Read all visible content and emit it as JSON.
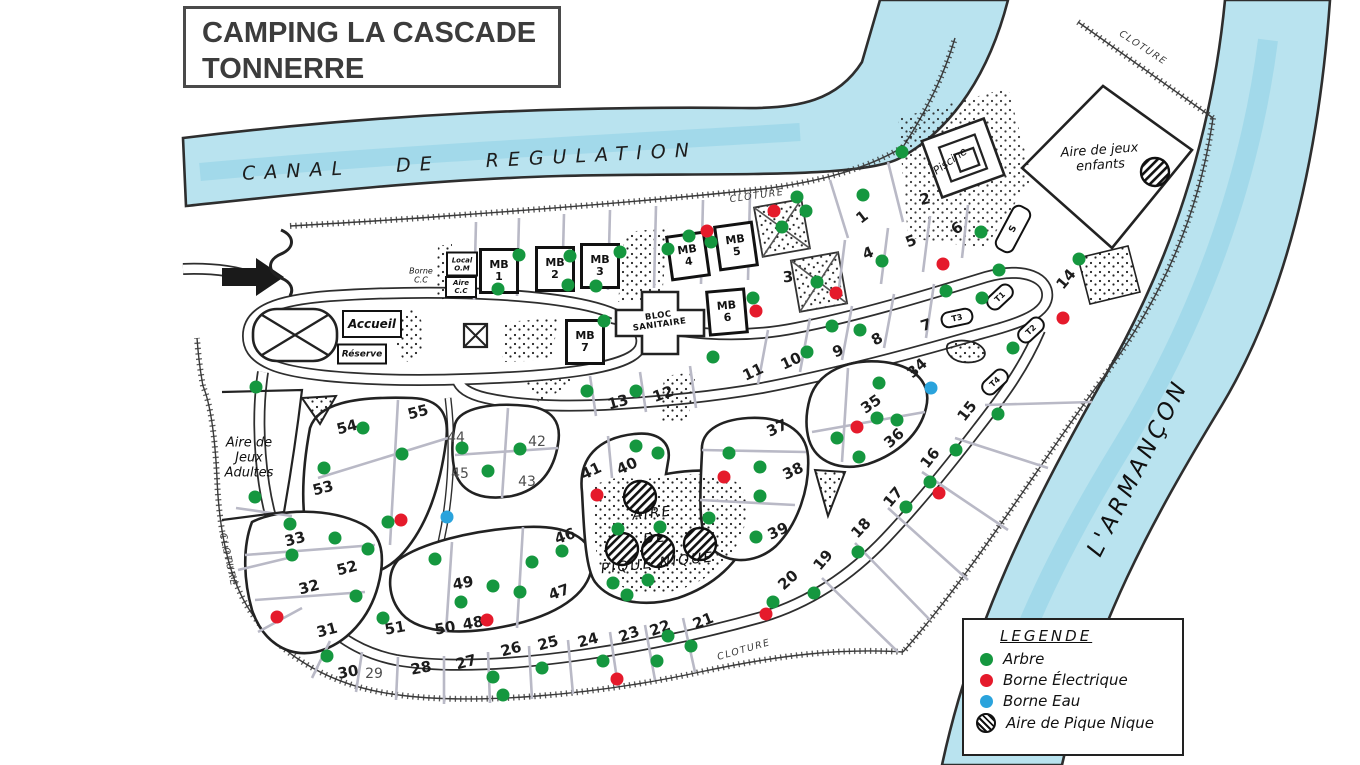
{
  "title": {
    "line1": "CAMPING LA CASCADE",
    "line2": "TONNERRE"
  },
  "legend": {
    "title": "LEGENDE",
    "items": [
      {
        "label": "Arbre",
        "type": "tree",
        "color": "#15973f"
      },
      {
        "label": "Borne Électrique",
        "type": "electric",
        "color": "#e51a2b"
      },
      {
        "label": "Borne Eau",
        "type": "water",
        "color": "#2aa3dc"
      },
      {
        "label": "Aire de Pique Nique",
        "type": "picnic",
        "color": "hatch"
      }
    ]
  },
  "colors": {
    "tree": "#15973f",
    "electric": "#e51a2b",
    "water": "#2aa3dc",
    "water_fill": "#b9e3ef",
    "ink": "#2d2d2d"
  },
  "map_labels": [
    {
      "text": "CANAL   DE   REGULATION",
      "x": 470,
      "y": 162,
      "rot": -3,
      "cls": "canal",
      "name": "canal-label"
    },
    {
      "text": "L'ARMANÇON",
      "x": 1138,
      "y": 468,
      "rot": -63,
      "cls": "river",
      "name": "river-label"
    },
    {
      "text": "CLOTURE",
      "x": 757,
      "y": 196,
      "rot": -8,
      "cls": "fence",
      "name": "fence-label-top"
    },
    {
      "text": "CLOTURE",
      "x": 1143,
      "y": 48,
      "rot": 33,
      "cls": "fence",
      "name": "fence-label-topright"
    },
    {
      "text": "CLOTURE",
      "x": 228,
      "y": 560,
      "rot": 78,
      "cls": "fence",
      "name": "fence-label-left"
    },
    {
      "text": "CLOTURE",
      "x": 744,
      "y": 650,
      "rot": -16,
      "cls": "fence",
      "name": "fence-label-bottom"
    },
    {
      "text": "Piscine",
      "x": 950,
      "y": 161,
      "rot": -35,
      "cls": "hand-sm",
      "name": "pool-label"
    },
    {
      "text": "Aire de jeux\nenfants",
      "x": 1100,
      "y": 158,
      "rot": -4,
      "cls": "hand",
      "name": "kids-playground-label"
    },
    {
      "text": "Aire de\nJeux\nAdultes",
      "x": 249,
      "y": 458,
      "rot": 0,
      "cls": "hand",
      "name": "adult-playground-label"
    },
    {
      "text": "AIRE\nDE\nPIQUE NIQUE",
      "x": 655,
      "y": 539,
      "rot": -6,
      "cls": "hand-lg",
      "name": "picnic-area-label"
    },
    {
      "text": "BLOC\nSANITAIRE",
      "x": 659,
      "y": 321,
      "rot": -8,
      "cls": "tiny-bold",
      "name": "sanitary-block-label"
    },
    {
      "text": "Borne\nC.C",
      "x": 421,
      "y": 276,
      "rot": 0,
      "cls": "tiny",
      "name": "borne-cc-label"
    }
  ],
  "boxes": [
    {
      "text": "MB\n1",
      "x": 499,
      "y": 271,
      "w": 34,
      "h": 40,
      "rot": 0,
      "cls": "mb",
      "name": "mobile-home-1"
    },
    {
      "text": "MB\n2",
      "x": 555,
      "y": 269,
      "w": 34,
      "h": 40,
      "rot": 0,
      "cls": "mb",
      "name": "mobile-home-2"
    },
    {
      "text": "MB\n3",
      "x": 600,
      "y": 266,
      "w": 34,
      "h": 40,
      "rot": 0,
      "cls": "mb",
      "name": "mobile-home-3"
    },
    {
      "text": "MB\n4",
      "x": 688,
      "y": 256,
      "w": 34,
      "h": 40,
      "rot": -8,
      "cls": "mb",
      "name": "mobile-home-4"
    },
    {
      "text": "MB\n5",
      "x": 736,
      "y": 246,
      "w": 34,
      "h": 40,
      "rot": -8,
      "cls": "mb",
      "name": "mobile-home-5"
    },
    {
      "text": "MB\n6",
      "x": 727,
      "y": 312,
      "w": 34,
      "h": 40,
      "rot": -5,
      "cls": "mb",
      "name": "mobile-home-6"
    },
    {
      "text": "MB\n7",
      "x": 585,
      "y": 342,
      "w": 34,
      "h": 40,
      "rot": 0,
      "cls": "mb",
      "name": "mobile-home-7"
    },
    {
      "text": "Accueil",
      "x": 372,
      "y": 324,
      "w": 56,
      "h": 24,
      "rot": 0,
      "cls": "plain",
      "fs": 12,
      "name": "reception"
    },
    {
      "text": "Réserve",
      "x": 362,
      "y": 354,
      "w": 46,
      "h": 17,
      "rot": 0,
      "cls": "plain",
      "fs": 9,
      "name": "reserve"
    },
    {
      "text": "Local\nO.M",
      "x": 462,
      "y": 264,
      "w": 28,
      "h": 21,
      "rot": 0,
      "cls": "plain",
      "fs": 7,
      "name": "local-om"
    },
    {
      "text": "Aire\nC.C",
      "x": 461,
      "y": 287,
      "w": 28,
      "h": 18,
      "rot": 0,
      "cls": "plain",
      "fs": 7,
      "name": "aire-cc"
    },
    {
      "text": "S",
      "x": 1013,
      "y": 229,
      "w": 46,
      "h": 17,
      "rot": -62,
      "cls": "rounded",
      "fs": 9,
      "name": "building-s"
    },
    {
      "text": "T1",
      "x": 1000,
      "y": 297,
      "w": 27,
      "h": 13,
      "rot": -43,
      "cls": "rounded",
      "fs": 8,
      "name": "tent-t1"
    },
    {
      "text": "T2",
      "x": 1031,
      "y": 330,
      "w": 27,
      "h": 13,
      "rot": -43,
      "cls": "rounded",
      "fs": 8,
      "name": "tent-t2"
    },
    {
      "text": "T3",
      "x": 957,
      "y": 318,
      "w": 29,
      "h": 13,
      "rot": -12,
      "cls": "rounded",
      "fs": 8,
      "name": "tent-t3"
    },
    {
      "text": "T4",
      "x": 995,
      "y": 382,
      "w": 27,
      "h": 13,
      "rot": -43,
      "cls": "rounded",
      "fs": 8,
      "name": "tent-t4"
    }
  ],
  "pitches": [
    {
      "n": "1",
      "x": 862,
      "y": 217,
      "r": -38
    },
    {
      "n": "2",
      "x": 925,
      "y": 199,
      "r": -12
    },
    {
      "n": "3",
      "x": 788,
      "y": 277,
      "r": -5
    },
    {
      "n": "4",
      "x": 868,
      "y": 253,
      "r": -22
    },
    {
      "n": "5",
      "x": 911,
      "y": 241,
      "r": -22
    },
    {
      "n": "6",
      "x": 957,
      "y": 228,
      "r": -35
    },
    {
      "n": "7",
      "x": 926,
      "y": 325,
      "r": -18
    },
    {
      "n": "8",
      "x": 877,
      "y": 339,
      "r": -28
    },
    {
      "n": "9",
      "x": 838,
      "y": 351,
      "r": -22
    },
    {
      "n": "10",
      "x": 791,
      "y": 361,
      "r": -25
    },
    {
      "n": "11",
      "x": 753,
      "y": 372,
      "r": -25
    },
    {
      "n": "12",
      "x": 663,
      "y": 394,
      "r": -20
    },
    {
      "n": "13",
      "x": 618,
      "y": 402,
      "r": -15
    },
    {
      "n": "14",
      "x": 1066,
      "y": 279,
      "r": -50
    },
    {
      "n": "15",
      "x": 967,
      "y": 411,
      "r": -52
    },
    {
      "n": "16",
      "x": 930,
      "y": 458,
      "r": -52
    },
    {
      "n": "17",
      "x": 893,
      "y": 497,
      "r": -50
    },
    {
      "n": "18",
      "x": 861,
      "y": 528,
      "r": -47
    },
    {
      "n": "19",
      "x": 823,
      "y": 560,
      "r": -50
    },
    {
      "n": "20",
      "x": 788,
      "y": 580,
      "r": -42
    },
    {
      "n": "21",
      "x": 703,
      "y": 621,
      "r": -22
    },
    {
      "n": "22",
      "x": 660,
      "y": 628,
      "r": -20
    },
    {
      "n": "23",
      "x": 629,
      "y": 634,
      "r": -20
    },
    {
      "n": "24",
      "x": 588,
      "y": 640,
      "r": -15
    },
    {
      "n": "25",
      "x": 548,
      "y": 643,
      "r": -15
    },
    {
      "n": "26",
      "x": 511,
      "y": 649,
      "r": -15
    },
    {
      "n": "27",
      "x": 466,
      "y": 662,
      "r": -15
    },
    {
      "n": "28",
      "x": 421,
      "y": 668,
      "r": -10
    },
    {
      "n": "29",
      "x": 374,
      "y": 674,
      "r": 0,
      "thin": true
    },
    {
      "n": "30",
      "x": 348,
      "y": 672,
      "r": -10
    },
    {
      "n": "31",
      "x": 327,
      "y": 630,
      "r": -15
    },
    {
      "n": "32",
      "x": 309,
      "y": 587,
      "r": -15
    },
    {
      "n": "33",
      "x": 295,
      "y": 539,
      "r": -15
    },
    {
      "n": "34",
      "x": 917,
      "y": 368,
      "r": -42
    },
    {
      "n": "35",
      "x": 871,
      "y": 404,
      "r": -35
    },
    {
      "n": "36",
      "x": 894,
      "y": 438,
      "r": -42
    },
    {
      "n": "37",
      "x": 777,
      "y": 428,
      "r": -25
    },
    {
      "n": "38",
      "x": 793,
      "y": 471,
      "r": -25
    },
    {
      "n": "39",
      "x": 778,
      "y": 531,
      "r": -25
    },
    {
      "n": "40",
      "x": 627,
      "y": 466,
      "r": -25
    },
    {
      "n": "41",
      "x": 591,
      "y": 471,
      "r": -25
    },
    {
      "n": "42",
      "x": 537,
      "y": 442,
      "r": 0,
      "thin": true
    },
    {
      "n": "43",
      "x": 527,
      "y": 482,
      "r": 0,
      "thin": true
    },
    {
      "n": "44",
      "x": 456,
      "y": 438,
      "r": 0,
      "thin": true
    },
    {
      "n": "45",
      "x": 460,
      "y": 474,
      "r": 0,
      "thin": true
    },
    {
      "n": "46",
      "x": 565,
      "y": 536,
      "r": -20
    },
    {
      "n": "47",
      "x": 559,
      "y": 592,
      "r": -20
    },
    {
      "n": "48",
      "x": 473,
      "y": 623,
      "r": -10
    },
    {
      "n": "49",
      "x": 463,
      "y": 583,
      "r": -10
    },
    {
      "n": "50",
      "x": 445,
      "y": 628,
      "r": -10
    },
    {
      "n": "51",
      "x": 395,
      "y": 628,
      "r": -10
    },
    {
      "n": "52",
      "x": 347,
      "y": 568,
      "r": -15
    },
    {
      "n": "53",
      "x": 323,
      "y": 488,
      "r": -15
    },
    {
      "n": "54",
      "x": 347,
      "y": 427,
      "r": -15
    },
    {
      "n": "55",
      "x": 418,
      "y": 412,
      "r": -15
    }
  ],
  "markers": {
    "trees": [
      [
        519,
        255
      ],
      [
        570,
        256
      ],
      [
        620,
        252
      ],
      [
        498,
        289
      ],
      [
        568,
        285
      ],
      [
        596,
        286
      ],
      [
        668,
        249
      ],
      [
        689,
        236
      ],
      [
        711,
        242
      ],
      [
        604,
        321
      ],
      [
        753,
        298
      ],
      [
        797,
        197
      ],
      [
        806,
        211
      ],
      [
        782,
        227
      ],
      [
        863,
        195
      ],
      [
        902,
        152
      ],
      [
        882,
        261
      ],
      [
        946,
        291
      ],
      [
        981,
        232
      ],
      [
        999,
        270
      ],
      [
        982,
        298
      ],
      [
        1013,
        348
      ],
      [
        1079,
        259
      ],
      [
        817,
        282
      ],
      [
        832,
        326
      ],
      [
        860,
        330
      ],
      [
        807,
        352
      ],
      [
        713,
        357
      ],
      [
        587,
        391
      ],
      [
        636,
        391
      ],
      [
        879,
        383
      ],
      [
        877,
        418
      ],
      [
        897,
        420
      ],
      [
        837,
        438
      ],
      [
        859,
        457
      ],
      [
        998,
        414
      ],
      [
        956,
        450
      ],
      [
        930,
        482
      ],
      [
        906,
        507
      ],
      [
        858,
        552
      ],
      [
        814,
        593
      ],
      [
        773,
        602
      ],
      [
        636,
        446
      ],
      [
        658,
        453
      ],
      [
        729,
        453
      ],
      [
        760,
        467
      ],
      [
        760,
        496
      ],
      [
        709,
        518
      ],
      [
        618,
        529
      ],
      [
        660,
        527
      ],
      [
        756,
        537
      ],
      [
        613,
        583
      ],
      [
        627,
        595
      ],
      [
        648,
        580
      ],
      [
        363,
        428
      ],
      [
        402,
        454
      ],
      [
        324,
        468
      ],
      [
        462,
        448
      ],
      [
        520,
        449
      ],
      [
        488,
        471
      ],
      [
        388,
        522
      ],
      [
        335,
        538
      ],
      [
        368,
        549
      ],
      [
        562,
        551
      ],
      [
        532,
        562
      ],
      [
        435,
        559
      ],
      [
        292,
        555
      ],
      [
        356,
        596
      ],
      [
        383,
        618
      ],
      [
        461,
        602
      ],
      [
        493,
        586
      ],
      [
        520,
        592
      ],
      [
        327,
        656
      ],
      [
        290,
        524
      ],
      [
        256,
        387
      ],
      [
        255,
        497
      ],
      [
        493,
        677
      ],
      [
        503,
        695
      ],
      [
        542,
        668
      ],
      [
        603,
        661
      ],
      [
        657,
        661
      ],
      [
        668,
        636
      ],
      [
        691,
        646
      ]
    ],
    "electric": [
      [
        707,
        231
      ],
      [
        774,
        211
      ],
      [
        836,
        293
      ],
      [
        756,
        311
      ],
      [
        943,
        264
      ],
      [
        1063,
        318
      ],
      [
        857,
        427
      ],
      [
        939,
        493
      ],
      [
        724,
        477
      ],
      [
        597,
        495
      ],
      [
        401,
        520
      ],
      [
        277,
        617
      ],
      [
        487,
        620
      ],
      [
        617,
        679
      ],
      [
        766,
        614
      ]
    ],
    "water": [
      [
        447,
        517
      ],
      [
        931,
        388
      ]
    ]
  }
}
